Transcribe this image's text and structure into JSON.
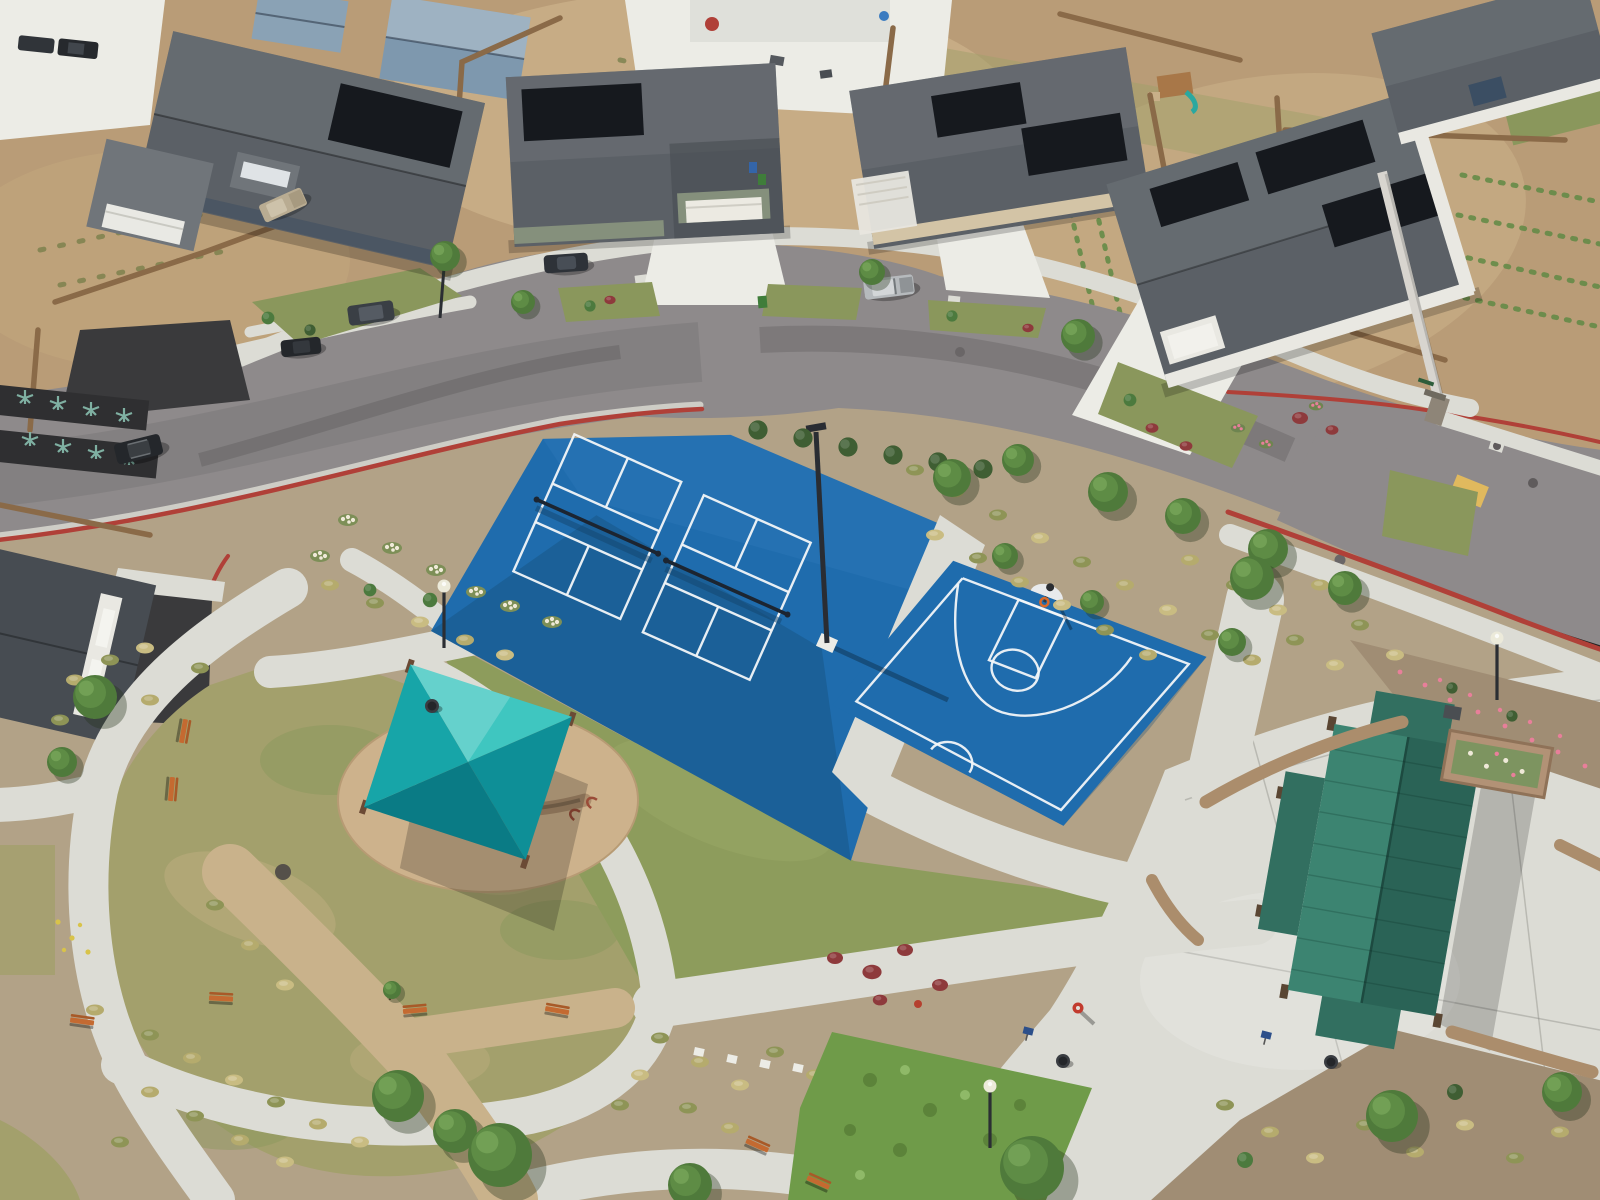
{
  "meta": {
    "type": "aerial-photo",
    "title": "Aerial view of a neighborhood park with sport courts",
    "description": "Drone aerial photo of a new suburban community park: two blue pickleball courts and a blue basketball half-court, a teal shade sail over a stone seat wall, a green-roofed picnic pavilion on a concrete plaza, curving concrete walking paths through lawns and ornamental grass beds, all wrapped by a curving residential street with single-family homes, rooftop solar panels, wood fences, red-painted curbs and parked vehicles."
  },
  "palette": {
    "dirt": "#b99c77",
    "dirt-light": "#cdb48c",
    "mulch": "#b2a287",
    "mulch-dark": "#a08d74",
    "road": "#8e8a8b",
    "road-dark": "#7c7879",
    "concrete": "#dcdcd5",
    "concrete-bright": "#ecece6",
    "dg-path": "#c9b28b",
    "gutter": "#d9d8d0",
    "curb-red": "#b04038",
    "ramp-yellow": "#e0b95e",
    "lawn": "#a3a06c",
    "lawn-dark": "#8a975c",
    "lawn-dry": "#b7aa7a",
    "lawn-court": "#8d9c5c",
    "shrub-field": "#6f9b49",
    "court-blue": "#1f6cad",
    "court-blue-deep": "#17517f",
    "court-line": "#f2f6f8",
    "net-dark": "#1c2531",
    "canopy-top": "#3fc6c0",
    "canopy-light": "#17a5a8",
    "canopy-mid": "#0e8f97",
    "canopy-dark": "#0a7b85",
    "pavilion-light": "#3c8471",
    "pavilion-mid": "#326f60",
    "pavilion-dark": "#2a6356",
    "stone-wall": "#ab8d6c",
    "sand-pad": "#cdb28c",
    "wood-fence": "#8a6a48",
    "solar-panel": "#16191e",
    "roof-light": "#70757a",
    "roof-mid": "#5b6066",
    "roof-dark": "#474c52",
    "wall-white": "#e9e8e2",
    "wall-tan": "#d3c4a6",
    "wall-green": "#85907c",
    "wall-slate": "#4b5663",
    "white-wall": "#d8d5cf",
    "bench-orange": "#c46a31",
    "tree-dark": "#4f7a3b",
    "tree-mid": "#5e8c45",
    "tree-light": "#72a055",
    "tuft-green": "#8e9456",
    "tuft-tan": "#b5ab6d",
    "tuft-dry": "#c9bc82",
    "shrub-green": "#4c7a3e",
    "shrub-red": "#8e3a3c",
    "flower-white": "#efe9d8",
    "flower-pink": "#e87f9a",
    "flower-yellow": "#d8c34a",
    "hydrant-red": "#c23b2e",
    "sign-blue": "#2c4f8a",
    "car-silver": "#b6babd",
    "car-beige": "#b9ac92",
    "car-dark": "#3a3f45",
    "car-black": "#24272b",
    "bin-green": "#3f7d3a",
    "bin-blue": "#3465a8",
    "shed-blue": "#7e98ae",
    "playset-teal": "#2aa8a0"
  },
  "scene": {
    "inventory": {
      "pickleball_courts": 2,
      "basketball_half_courts": 1,
      "shade_sail_canopies": 1,
      "picnic_pavilions": 1,
      "park_benches": 8,
      "street_lamps": 3,
      "sports_light_poles": 1,
      "trash_cans": 3,
      "bike_racks": 2,
      "fire_hydrants": 1,
      "parked_vehicles": 7,
      "houses_fronting_street": 5
    }
  }
}
